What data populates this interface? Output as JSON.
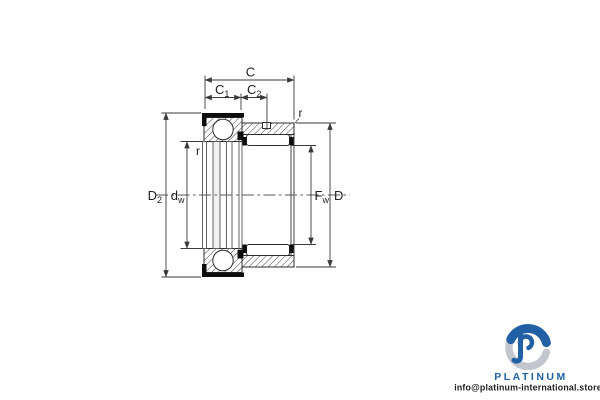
{
  "drawing": {
    "type": "bearing-cross-section",
    "labels": {
      "c": "C",
      "c1_main": "C",
      "c1_sub": "1",
      "c2_main": "C",
      "c2_sub": "2",
      "r_outer": "r",
      "r_inner": "r",
      "d2_main": "D",
      "d2_sub": "2",
      "dw_main": "d",
      "dw_sub": "w",
      "fw_main": "F",
      "fw_sub": "w",
      "d_main": "D"
    },
    "colors": {
      "outline": "#2e2e2e",
      "dim": "#3a3a3a",
      "hatch": "#4a4a4a",
      "seal": "#0d0d0d",
      "centerline": "#555555",
      "label_text": "#1f1f1f"
    }
  },
  "branding": {
    "name": "PLATINUM",
    "email": "info@platinum-international.store",
    "colors": {
      "blue": "#2160a5",
      "gray": "#c3c7cd",
      "text": "#1f1f1f"
    }
  }
}
